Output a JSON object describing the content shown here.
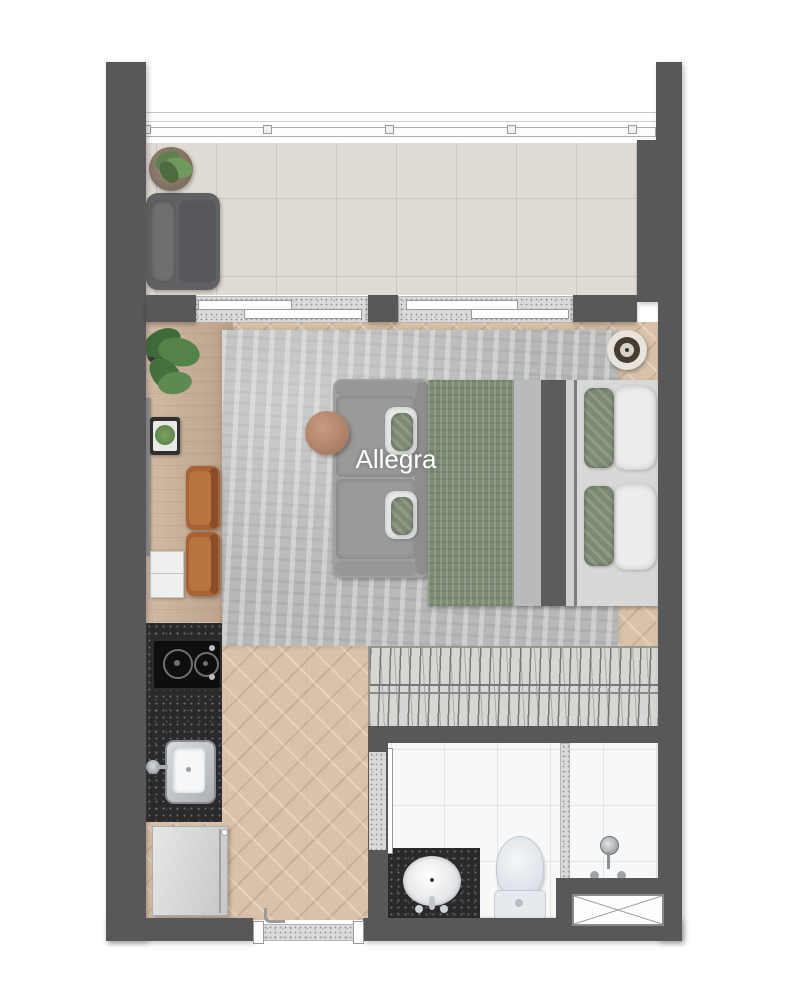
{
  "floor_plan": {
    "unit_label": "Allegra",
    "rooms": [
      "balcony",
      "living-bedroom",
      "kitchen",
      "hall",
      "closet",
      "bathroom",
      "entry"
    ],
    "fixtures": [
      "balcony-armchair",
      "potted-plant",
      "sliding-glass-doors",
      "wall-tv",
      "desk-sideboard",
      "monstera-plant",
      "serving-tray",
      "leather-chair-1",
      "leather-chair-2",
      "laptop",
      "area-rug",
      "two-seat-sofa",
      "round-coffee-table",
      "double-bed",
      "round-side-decor",
      "wardrobe-with-hangers",
      "two-burner-cooktop",
      "kitchen-sink",
      "refrigerator",
      "entry-door",
      "bathroom-sliding-door",
      "vanity-with-sink",
      "toilet",
      "shower-set",
      "ventilation-shaft"
    ],
    "colors": {
      "wall": "#58585a",
      "balcony_tile": "#e0dcd4",
      "wood_floor": "#d9c2a9",
      "rug": "#b6b8b9",
      "sofa": "#9d9d9b",
      "bed_blanket_green": "#7e8b75",
      "bed_stripe_dark": "#5a5c5e",
      "leather_chair": "#a96236",
      "counter_granite": "#2a2a2c",
      "bathroom_floor": "#f8f8f8",
      "fixture_white": "#eceef0",
      "label_text": "#ffffff"
    }
  }
}
